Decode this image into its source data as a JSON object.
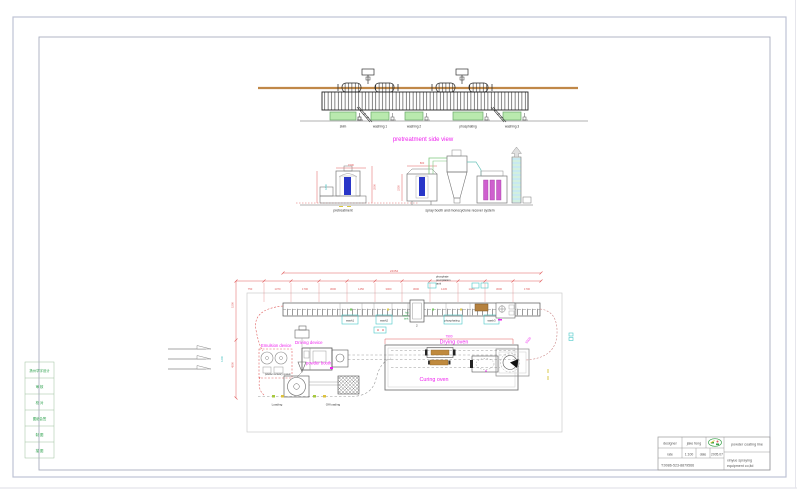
{
  "side_view": {
    "title": "pretreatment side view",
    "tanks": [
      "skim",
      "washing 1",
      "washing 2",
      "phosphating",
      "washing 3"
    ]
  },
  "elevations": {
    "pretreatment_label": "pretreatment",
    "spray_label": "spray booth and monocyclone recover system",
    "dims": {
      "pre_w": "1500",
      "pre_h": "2500",
      "pre_h2": "1800",
      "booth_w": "800",
      "booth_h": "2250"
    }
  },
  "plan": {
    "labels": {
      "emulsion": "Emulsion device",
      "driving": "Driving device",
      "powder_booth": "powder booth",
      "powder_recovery": "powder recovery system",
      "drying": "Drying oven",
      "curing": "Curing oven",
      "loading": "Loading",
      "off_loading": "Off loading",
      "wash1": "wash1",
      "wash2": "wash2",
      "phosphating": "phosphating",
      "wash3": "wash3",
      "precip": [
        "phosphate",
        "precipitation",
        "tank"
      ],
      "unit": [
        "hot",
        "water",
        "tank"
      ],
      "unit_mark": "2"
    },
    "dims": {
      "total": "24354",
      "segments": [
        "750",
        "1370",
        "1700",
        "3000",
        "1450",
        "3000",
        "3000",
        "1445",
        "1480",
        "3000",
        "1700"
      ],
      "left1": "1500",
      "left2": "4500",
      "oven": "7900",
      "turn": "5500",
      "side": "1200"
    }
  },
  "title_block": {
    "designer_label": "designer",
    "designer": "jake feng",
    "rate_label": "rate",
    "rate": "1:100",
    "date_label": "date",
    "date": "2005.07",
    "phone": "T:0086-523-8879566",
    "project": "powder coating line",
    "company1": "xinyue spraying",
    "company2": "equipment co,ltd"
  },
  "rev_table": {
    "rows": [
      "扬州华宇设计",
      "审 核",
      "校 对",
      "图纸会签",
      "制 图",
      "描 图"
    ]
  },
  "colors": {
    "magenta": "#ee22ee",
    "dim_red": "#e05a5a",
    "tank_green": "#b9e9ae",
    "beam_tan": "#c08848",
    "blue": "#2936c8",
    "cyan": "#49c8c8"
  }
}
